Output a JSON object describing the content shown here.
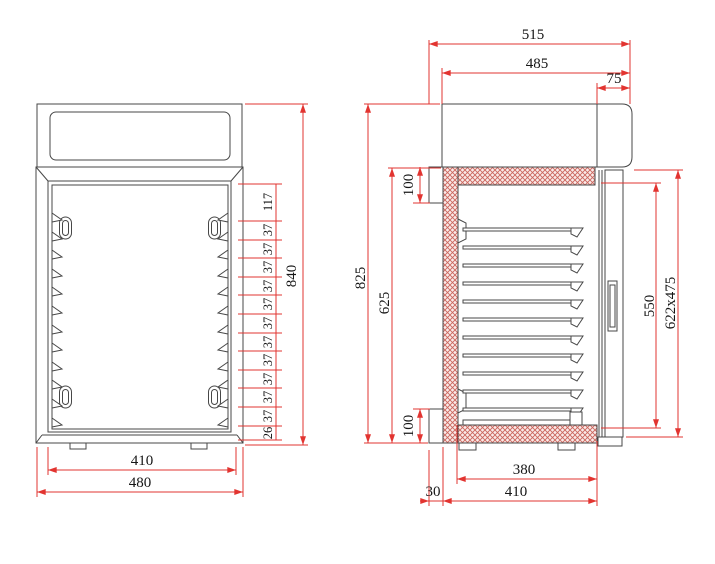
{
  "drawing": {
    "type": "technical-drawing-two-views",
    "views": {
      "front": {
        "dim_inner_width": "410",
        "dim_outer_width": "480",
        "dim_overall_height": "840",
        "stack": [
          "117",
          "37",
          "37",
          "37",
          "37",
          "37",
          "37",
          "37",
          "37",
          "37",
          "37",
          "37",
          "26"
        ]
      },
      "side": {
        "dim_overall_width": "515",
        "dim_body_width": "485",
        "dim_top_right": "75",
        "dim_flange_top": "100",
        "dim_flange_bottom": "100",
        "dim_overall_height": "825",
        "dim_insulated_height": "625",
        "dim_chamber_height": "550",
        "dim_door": "622x475",
        "dim_tray_width": "380",
        "dim_base_width": "410",
        "dim_back_offset": "30"
      }
    },
    "colors": {
      "dimension": "#e23430",
      "line": "#474747",
      "hatch": "#cb665e",
      "hatch_bg": "#faeae8",
      "background": "#ffffff",
      "text": "#161616"
    }
  }
}
